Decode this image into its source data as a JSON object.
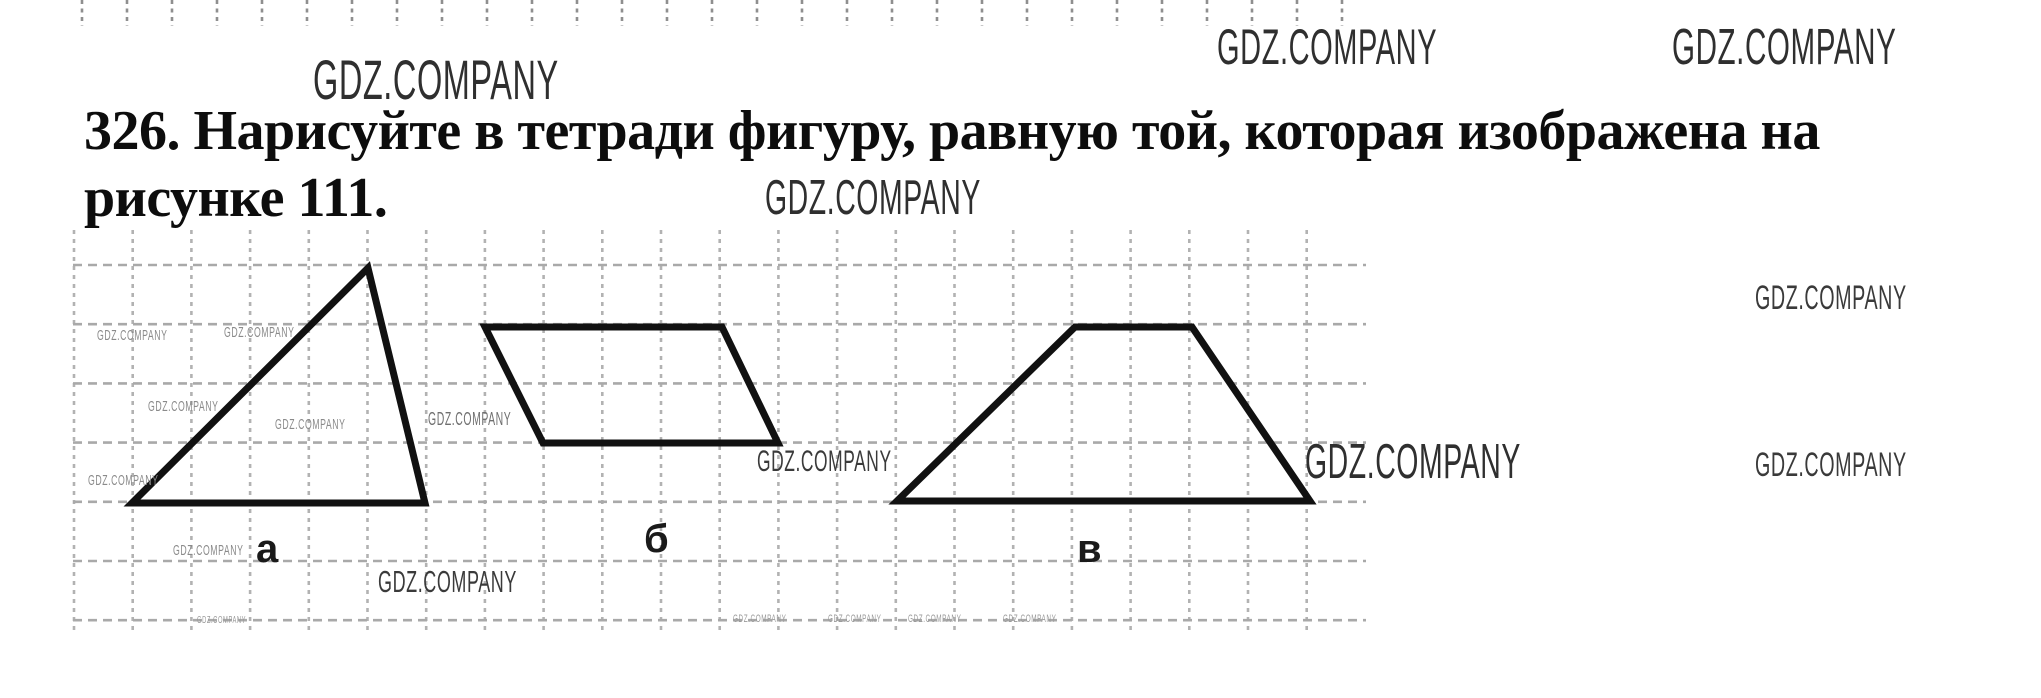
{
  "watermark_text": "GDZ.COMPANY",
  "title": {
    "line1": "326. Нарисуйте в тетради фигуру, равную той, которая изображена на",
    "line2": "рисунке 111."
  },
  "figure": {
    "stroke_color": "#111111",
    "shapes": [
      {
        "type": "triangle",
        "label": "а",
        "points": [
          [
            132,
            503
          ],
          [
            425,
            503
          ],
          [
            368,
            268
          ]
        ],
        "label_pos": [
          256,
          529
        ]
      },
      {
        "type": "parallelogram",
        "label": "б",
        "points": [
          [
            485,
            327
          ],
          [
            722,
            327
          ],
          [
            778,
            443
          ],
          [
            543,
            443
          ]
        ],
        "label_pos": [
          644,
          519
        ]
      },
      {
        "type": "trapezoid",
        "label": "в",
        "points": [
          [
            897,
            501
          ],
          [
            1075,
            327
          ],
          [
            1192,
            327
          ],
          [
            1310,
            501
          ]
        ],
        "label_pos": [
          1077,
          529
        ]
      }
    ]
  },
  "watermarks": [
    {
      "x": 313,
      "y": 62,
      "fs": 56,
      "color": "#2f2f2f"
    },
    {
      "x": 1217,
      "y": 31,
      "fs": 50,
      "color": "#2f2f2f"
    },
    {
      "x": 1672,
      "y": 30,
      "fs": 51,
      "color": "#2f2f2f"
    },
    {
      "x": 765,
      "y": 183,
      "fs": 49,
      "color": "#2f2f2f"
    },
    {
      "x": 1305,
      "y": 447,
      "fs": 49,
      "color": "#2f2f2f"
    },
    {
      "x": 1755,
      "y": 287,
      "fs": 34,
      "color": "#3a3a3a"
    },
    {
      "x": 1755,
      "y": 454,
      "fs": 34,
      "color": "#3a3a3a"
    },
    {
      "x": 757,
      "y": 452,
      "fs": 30,
      "color": "#3a3a3a"
    },
    {
      "x": 378,
      "y": 572,
      "fs": 31,
      "color": "#3a3a3a"
    },
    {
      "x": 428,
      "y": 413,
      "fs": 18,
      "color": "#6f6f6f"
    },
    {
      "x": 97,
      "y": 331,
      "fs": 15,
      "color": "#8a8a8a"
    },
    {
      "x": 224,
      "y": 328,
      "fs": 15,
      "color": "#8a8a8a"
    },
    {
      "x": 148,
      "y": 402,
      "fs": 15,
      "color": "#8a8a8a"
    },
    {
      "x": 275,
      "y": 420,
      "fs": 15,
      "color": "#8a8a8a"
    },
    {
      "x": 88,
      "y": 476,
      "fs": 15,
      "color": "#8a8a8a"
    },
    {
      "x": 173,
      "y": 546,
      "fs": 15,
      "color": "#8a8a8a"
    },
    {
      "x": 197,
      "y": 618,
      "fs": 10,
      "color": "#9a9a9a"
    },
    {
      "x": 733,
      "y": 616,
      "fs": 11,
      "color": "#9a9a9a"
    },
    {
      "x": 828,
      "y": 616,
      "fs": 11,
      "color": "#9a9a9a"
    },
    {
      "x": 908,
      "y": 616,
      "fs": 11,
      "color": "#9a9a9a"
    },
    {
      "x": 1003,
      "y": 616,
      "fs": 11,
      "color": "#9a9a9a"
    }
  ],
  "grid": {
    "vertical": {
      "x_start": 74,
      "step": 58.7,
      "x_end": 1310,
      "y1": 230,
      "y2": 632
    },
    "horizontal": {
      "y_start": 265,
      "step": 59.2,
      "count": 7,
      "x1": 73,
      "x2": 1366
    },
    "top_strip": {
      "x_start": 82,
      "step": 45,
      "x_end": 1345,
      "y1": 0,
      "y2": 26
    }
  }
}
